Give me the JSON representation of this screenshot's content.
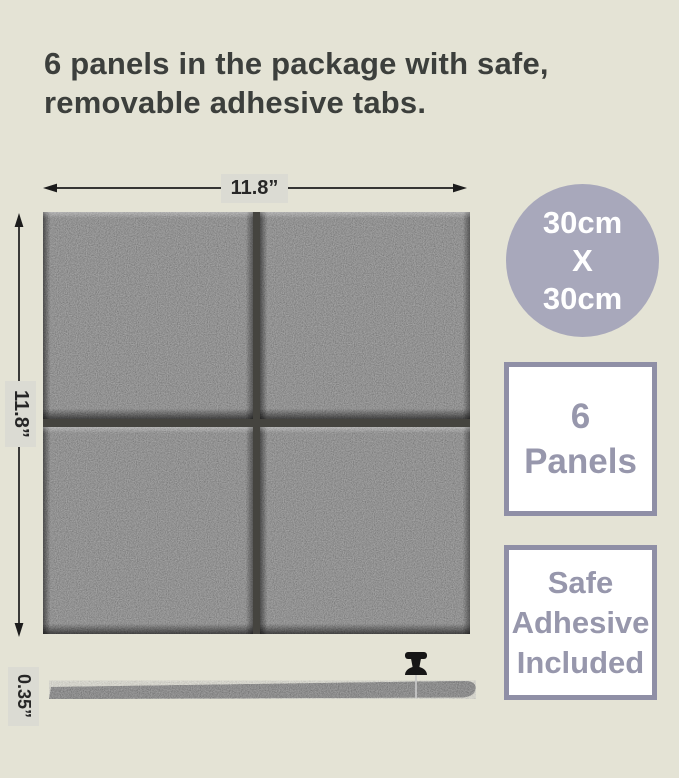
{
  "headline": {
    "line1": "6 panels in the package with safe,",
    "line2": "removable adhesive tabs."
  },
  "front_view": {
    "width_label": "11.8”",
    "height_label": "11.8”"
  },
  "side_view": {
    "thickness_label": "0.35”"
  },
  "badges": {
    "size_circle": {
      "lines": [
        "30cm",
        "X",
        "30cm"
      ]
    },
    "panel_count": {
      "lines": [
        "6",
        "Panels"
      ]
    },
    "adhesive": {
      "lines": [
        "Safe",
        "Adhesive",
        "Included"
      ]
    }
  },
  "icons": {
    "push_pin": "push-pin-icon",
    "width_arrow": "horizontal-double-arrow",
    "height_arrow": "vertical-double-arrow"
  },
  "colors": {
    "background": "#e4e3d5",
    "headline_text": "#3c3f3c",
    "badge_fill": "#a8a8bb",
    "badge_border": "#8f8fa6",
    "badge_text": "#9797ac",
    "dim_label_bg": "#dbdbd3",
    "panel_felt": "#737373"
  }
}
